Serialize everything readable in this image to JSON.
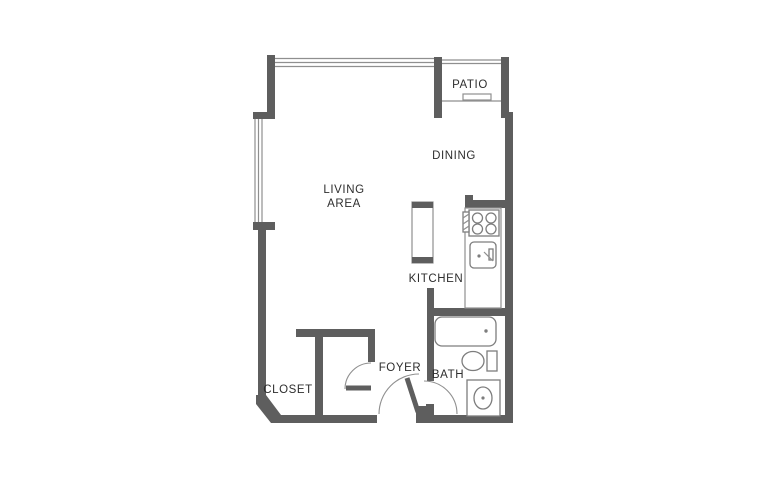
{
  "title": "Studio apartment floor plan",
  "colors": {
    "wall": "#5e5e5e",
    "line": "#8f8f8f",
    "fixture": "#7d7d7d",
    "text": "#2e2e2e"
  },
  "rooms": {
    "patio": {
      "label": "PATIO"
    },
    "dining": {
      "label": "DINING"
    },
    "living": {
      "label_line1": "LIVING",
      "label_line2": "AREA"
    },
    "kitchen": {
      "label": "KITCHEN"
    },
    "closet": {
      "label": "CLOSET"
    },
    "foyer": {
      "label": "FOYER"
    },
    "bath": {
      "label": "BATH"
    }
  },
  "fixtures": {
    "stove": "stove-4-burners",
    "kitchen_sink": "kitchen-sink",
    "island": "counter-peninsula",
    "bathtub": "bathtub",
    "toilet": "toilet",
    "vanity": "vanity-sink",
    "sliding_door": "patio-sliding-door",
    "windows": [
      "top-window",
      "left-window"
    ]
  }
}
